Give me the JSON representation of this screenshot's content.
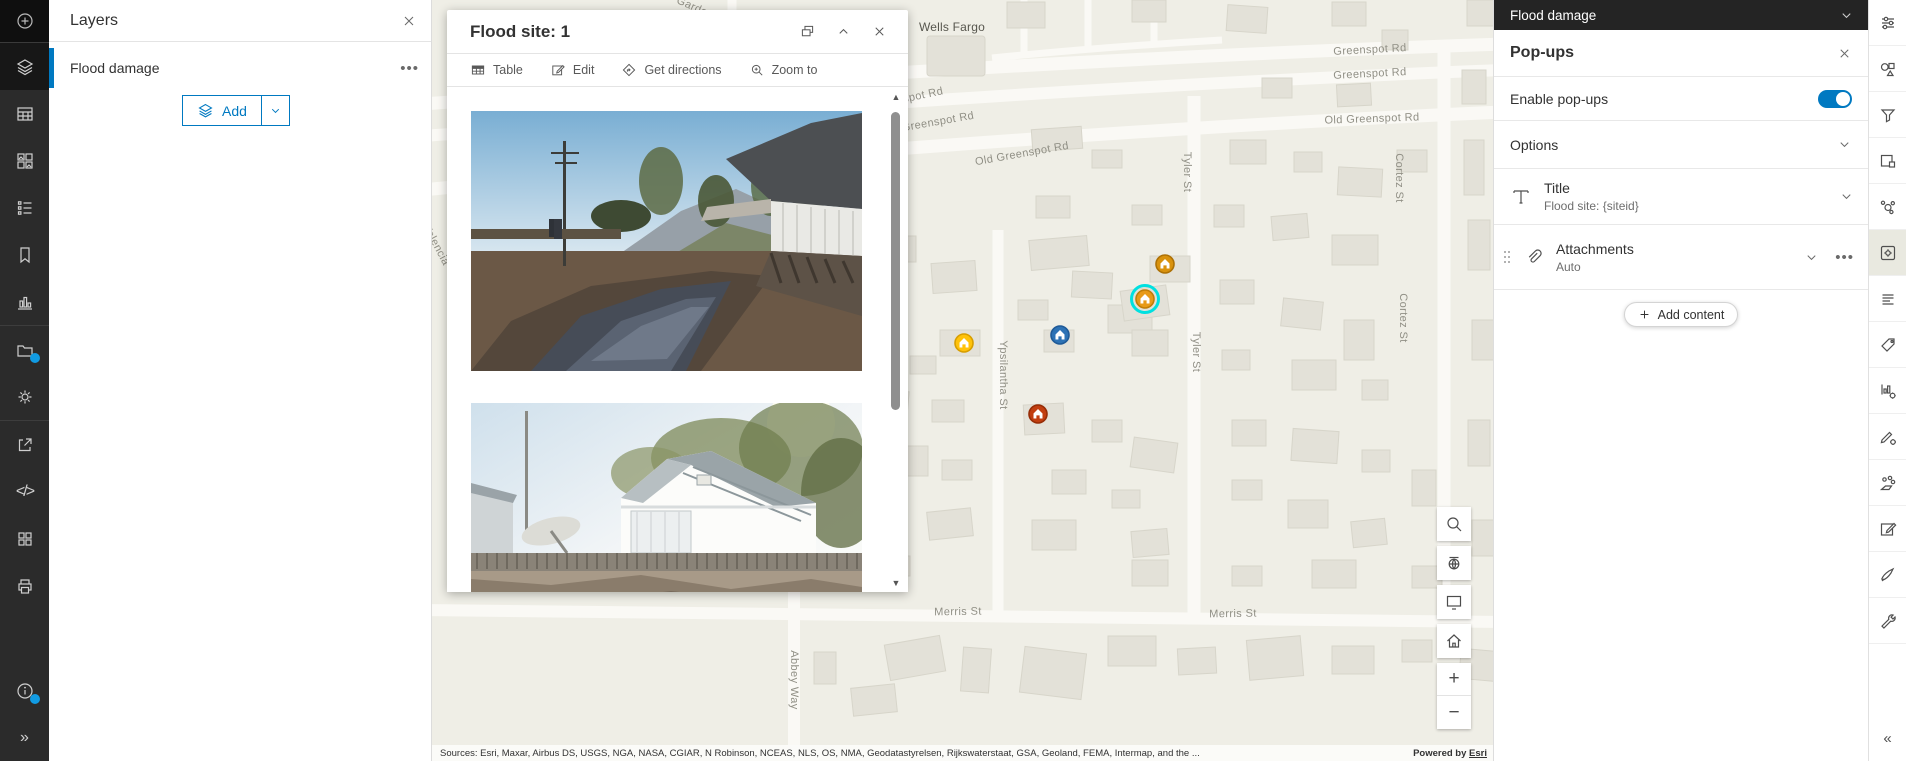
{
  "colors": {
    "accent": "#0079c1",
    "header_dark": "#242424",
    "map_bg": "#efeee6",
    "selection_ring": "#00e0e0",
    "notification_dot": "#119be3"
  },
  "left_rail": {
    "items": [
      {
        "name": "add-layer",
        "icon": "plus-circle"
      },
      {
        "name": "layers",
        "icon": "layers",
        "active": true
      },
      {
        "name": "tables",
        "icon": "table"
      },
      {
        "name": "basemap",
        "icon": "basemap"
      },
      {
        "name": "legend",
        "icon": "legend"
      },
      {
        "name": "bookmarks",
        "icon": "bookmark"
      },
      {
        "name": "charts",
        "icon": "charts"
      },
      {
        "name": "save",
        "icon": "folder",
        "dot": true,
        "sep_before": true
      },
      {
        "name": "map-properties",
        "icon": "gear"
      },
      {
        "name": "share",
        "icon": "share",
        "sep_before": true
      },
      {
        "name": "embed",
        "icon": "code"
      },
      {
        "name": "apps",
        "icon": "apps"
      },
      {
        "name": "print",
        "icon": "print"
      }
    ],
    "bottom_items": [
      {
        "name": "info",
        "icon": "info",
        "dot": true
      },
      {
        "name": "expand",
        "icon": "expand"
      }
    ]
  },
  "layers_panel": {
    "title": "Layers",
    "layer_name": "Flood damage",
    "add_button_label": "Add"
  },
  "popup": {
    "title": "Flood site: 1",
    "actions": [
      {
        "name": "table",
        "icon": "grid-table",
        "label": "Table"
      },
      {
        "name": "edit",
        "icon": "edit-square",
        "label": "Edit"
      },
      {
        "name": "get-directions",
        "icon": "directions",
        "label": "Get directions"
      },
      {
        "name": "zoom-to",
        "icon": "zoom-plus",
        "label": "Zoom to"
      }
    ]
  },
  "map": {
    "street_labels": [
      {
        "text": "Garden",
        "x": 263,
        "y": 8,
        "rot": 24
      },
      {
        "text": "Wells Fargo",
        "x": 520,
        "y": 27,
        "rot": 0,
        "poi": true
      },
      {
        "text": "Greenspot Rd",
        "x": 938,
        "y": 50,
        "rot": -3
      },
      {
        "text": "Greenspot Rd",
        "x": 938,
        "y": 74,
        "rot": -3
      },
      {
        "text": "nspot Rd",
        "x": 488,
        "y": 96,
        "rot": -12
      },
      {
        "text": "Greenspot Rd",
        "x": 506,
        "y": 122,
        "rot": -10
      },
      {
        "text": "Old Greenspot Rd",
        "x": 590,
        "y": 154,
        "rot": -10
      },
      {
        "text": "Old Greenspot Rd",
        "x": 940,
        "y": 119,
        "rot": -2
      },
      {
        "text": "Tyler St",
        "x": 755,
        "y": 172,
        "rot": 90
      },
      {
        "text": "Tyler St",
        "x": 764,
        "y": 352,
        "rot": 90
      },
      {
        "text": "Cortez St",
        "x": 967,
        "y": 178,
        "rot": 90
      },
      {
        "text": "Cortez St",
        "x": 971,
        "y": 318,
        "rot": 90
      },
      {
        "text": "Ypsilantha St",
        "x": 571,
        "y": 375,
        "rot": 90
      },
      {
        "text": "Abbey Way",
        "x": 362,
        "y": 680,
        "rot": 90
      },
      {
        "text": "Merris St",
        "x": 526,
        "y": 612,
        "rot": -1
      },
      {
        "text": "Merris St",
        "x": 801,
        "y": 614,
        "rot": -1
      },
      {
        "text": "Valencia",
        "x": 4,
        "y": 245,
        "rot": 62
      }
    ],
    "markers": [
      {
        "x": 532,
        "y": 343,
        "fill": "#FFC20A",
        "rim": "#D79E00"
      },
      {
        "x": 628,
        "y": 335,
        "fill": "#2D72B5",
        "rim": "#1F5A97"
      },
      {
        "x": 733,
        "y": 264,
        "fill": "#D9920D",
        "rim": "#AD7106"
      },
      {
        "x": 713,
        "y": 299,
        "fill": "#E89A18",
        "rim": "#C07D08",
        "selected": true
      },
      {
        "x": 606,
        "y": 414,
        "fill": "#C23E10",
        "rim": "#962D07"
      }
    ],
    "controls": [
      {
        "name": "search",
        "icon": "search"
      },
      {
        "name": "basemap-toggle",
        "icon": "globe"
      },
      {
        "name": "screen",
        "icon": "monitor"
      },
      {
        "name": "home",
        "icon": "home"
      }
    ],
    "zoom_in": "+",
    "zoom_out": "−",
    "attribution": {
      "sources": "Sources: Esri, Maxar, Airbus DS, USGS, NGA, NASA, CGIAR, N Robinson, NCEAS, NLS, OS, NMA, Geodatastyrelsen, Rijkswaterstaat, GSA, Geoland, FEMA, Intermap, and the ...",
      "powered": "Powered by",
      "esri": "Esri"
    }
  },
  "right_panel": {
    "header_title": "Flood damage",
    "panel_title": "Pop-ups",
    "enable_label": "Enable pop-ups",
    "enabled": true,
    "options_label": "Options",
    "content_items": [
      {
        "name": "title",
        "label": "Title",
        "subtitle": "Flood site: {siteid}"
      },
      {
        "name": "attachments",
        "label": "Attachments",
        "subtitle": "Auto"
      }
    ],
    "add_content_label": "Add content"
  },
  "right_rail": {
    "items": [
      {
        "name": "properties",
        "icon": "sliders"
      },
      {
        "name": "styles",
        "icon": "shapes"
      },
      {
        "name": "filter",
        "icon": "funnel"
      },
      {
        "name": "fields",
        "icon": "fields"
      },
      {
        "name": "clustering",
        "icon": "cluster"
      },
      {
        "name": "popups",
        "icon": "popup-gear",
        "active": true
      },
      {
        "name": "labels",
        "icon": "text-lines"
      },
      {
        "name": "tags",
        "icon": "tag"
      },
      {
        "name": "chart-config",
        "icon": "chart-gear"
      },
      {
        "name": "style-editor",
        "icon": "pen-gear"
      },
      {
        "name": "sketch",
        "icon": "sketch"
      },
      {
        "name": "edit",
        "icon": "edit-square"
      },
      {
        "name": "forms",
        "icon": "pen"
      },
      {
        "name": "utilities",
        "icon": "wrench"
      }
    ]
  }
}
